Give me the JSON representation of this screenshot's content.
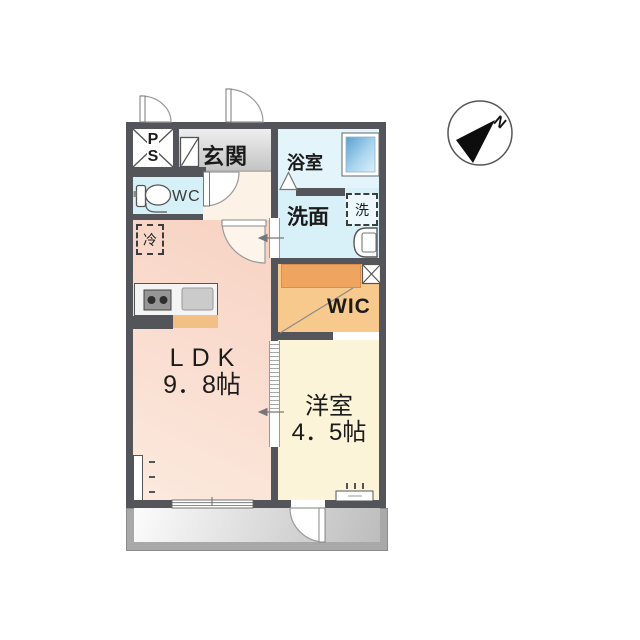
{
  "compass": {
    "north_label": "N"
  },
  "rooms": {
    "ps": {
      "letters": [
        "P",
        "S"
      ]
    },
    "entrance": {
      "label": "玄関"
    },
    "bathroom": {
      "label": "浴室"
    },
    "toilet": {
      "label": "WC"
    },
    "washroom": {
      "label": "洗面"
    },
    "washer": {
      "label": "洗"
    },
    "refrigerator": {
      "label": "冷"
    },
    "walk_in_closet": {
      "label": "WIC"
    },
    "ldk": {
      "label": "LDK",
      "size": "9．8帖"
    },
    "western_room": {
      "label": "洋室",
      "size": "4．5帖"
    }
  },
  "colors": {
    "wall": "#54555a",
    "ldk_floor": "#f9dbcc",
    "wet_area_floor": "#d8f0f8",
    "wic_floor": "#f8c98c",
    "closet_shelf": "#efa45f",
    "western_room_floor": "#fcf4d8",
    "entrance_floor": "#d9d9d9",
    "balcony_floor": "#cfcfcf",
    "bath_window": "#5d9fd0"
  }
}
